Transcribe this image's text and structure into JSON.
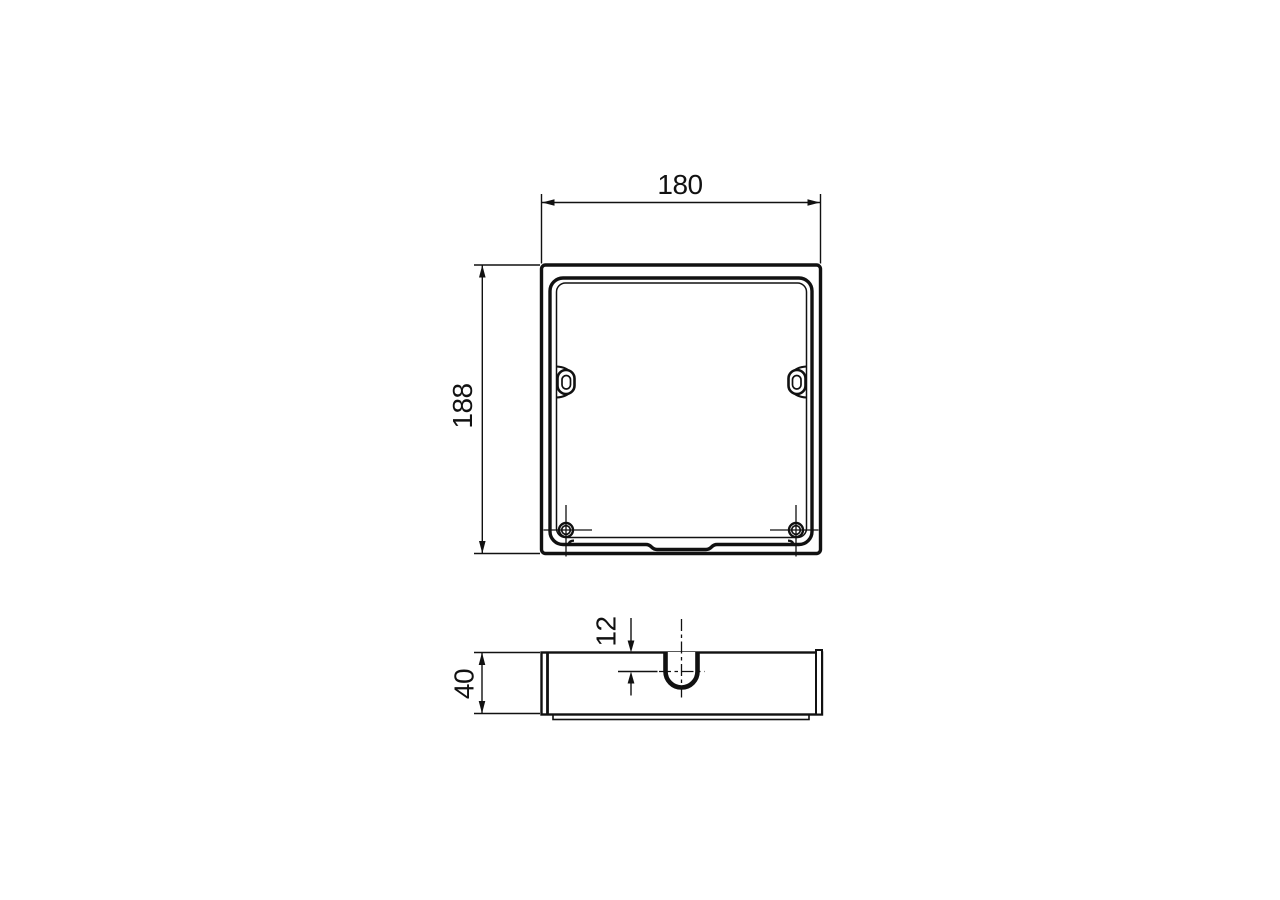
{
  "drawing": {
    "type": "technical-dimension-drawing",
    "views": {
      "top_view": "square box front view",
      "side_view": "box profile view"
    },
    "dimensions": {
      "top_width": "180",
      "top_height": "188",
      "side_depth": "40",
      "notch_offset": "12"
    }
  },
  "colors": {
    "line": "#111111",
    "background": "#ffffff"
  }
}
